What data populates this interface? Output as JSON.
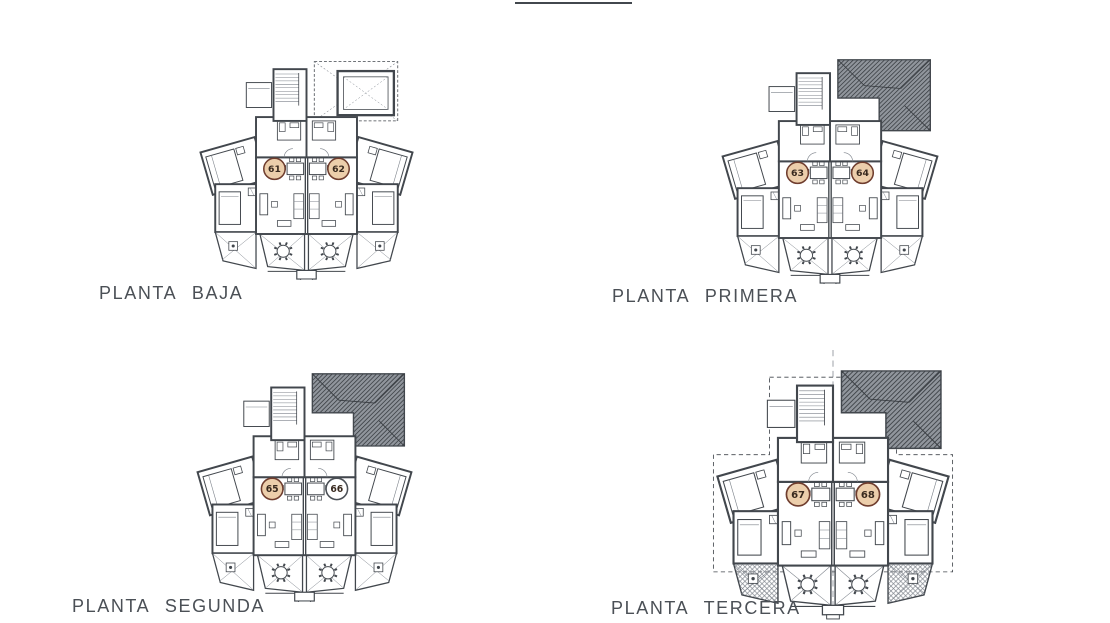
{
  "document": {
    "type": "architectural-floor-plan-sheet",
    "top_rule_present": true
  },
  "colors": {
    "ink": "#42474d",
    "ink_light": "#7c828a",
    "label_text": "#4b5056",
    "roof_dark": "#383c41",
    "roof_mid": "#90959c",
    "unit_circle_fill": "#ecceab",
    "unit_circle_stroke": "#6f3d2e",
    "unit_circle_text": "#38291e",
    "unit_circle_white_fill": "#ffffff",
    "unit_circle_white_stroke": "#4b5056"
  },
  "plans": [
    {
      "id": "baja",
      "label": "PLANTA BAJA",
      "units": [
        {
          "number": "61",
          "filled": true
        },
        {
          "number": "62",
          "filled": true
        }
      ],
      "features": {
        "top": "dashed-attic",
        "dashed_outline": false,
        "hatched_corner_terraces": false,
        "centerline": false
      }
    },
    {
      "id": "primera",
      "label": "PLANTA PRIMERA",
      "units": [
        {
          "number": "63",
          "filled": true
        },
        {
          "number": "64",
          "filled": true
        }
      ],
      "features": {
        "top": "hip-roof",
        "dashed_outline": false,
        "hatched_corner_terraces": false,
        "centerline": false
      }
    },
    {
      "id": "segunda",
      "label": "PLANTA SEGUNDA",
      "units": [
        {
          "number": "65",
          "filled": true
        },
        {
          "number": "66",
          "filled": false
        }
      ],
      "features": {
        "top": "hip-roof",
        "dashed_outline": false,
        "hatched_corner_terraces": false,
        "centerline": false
      }
    },
    {
      "id": "tercera",
      "label": "PLANTA TERCERA",
      "units": [
        {
          "number": "67",
          "filled": true
        },
        {
          "number": "68",
          "filled": true
        }
      ],
      "features": {
        "top": "hip-roof",
        "dashed_outline": true,
        "hatched_corner_terraces": true,
        "centerline": true
      }
    }
  ]
}
